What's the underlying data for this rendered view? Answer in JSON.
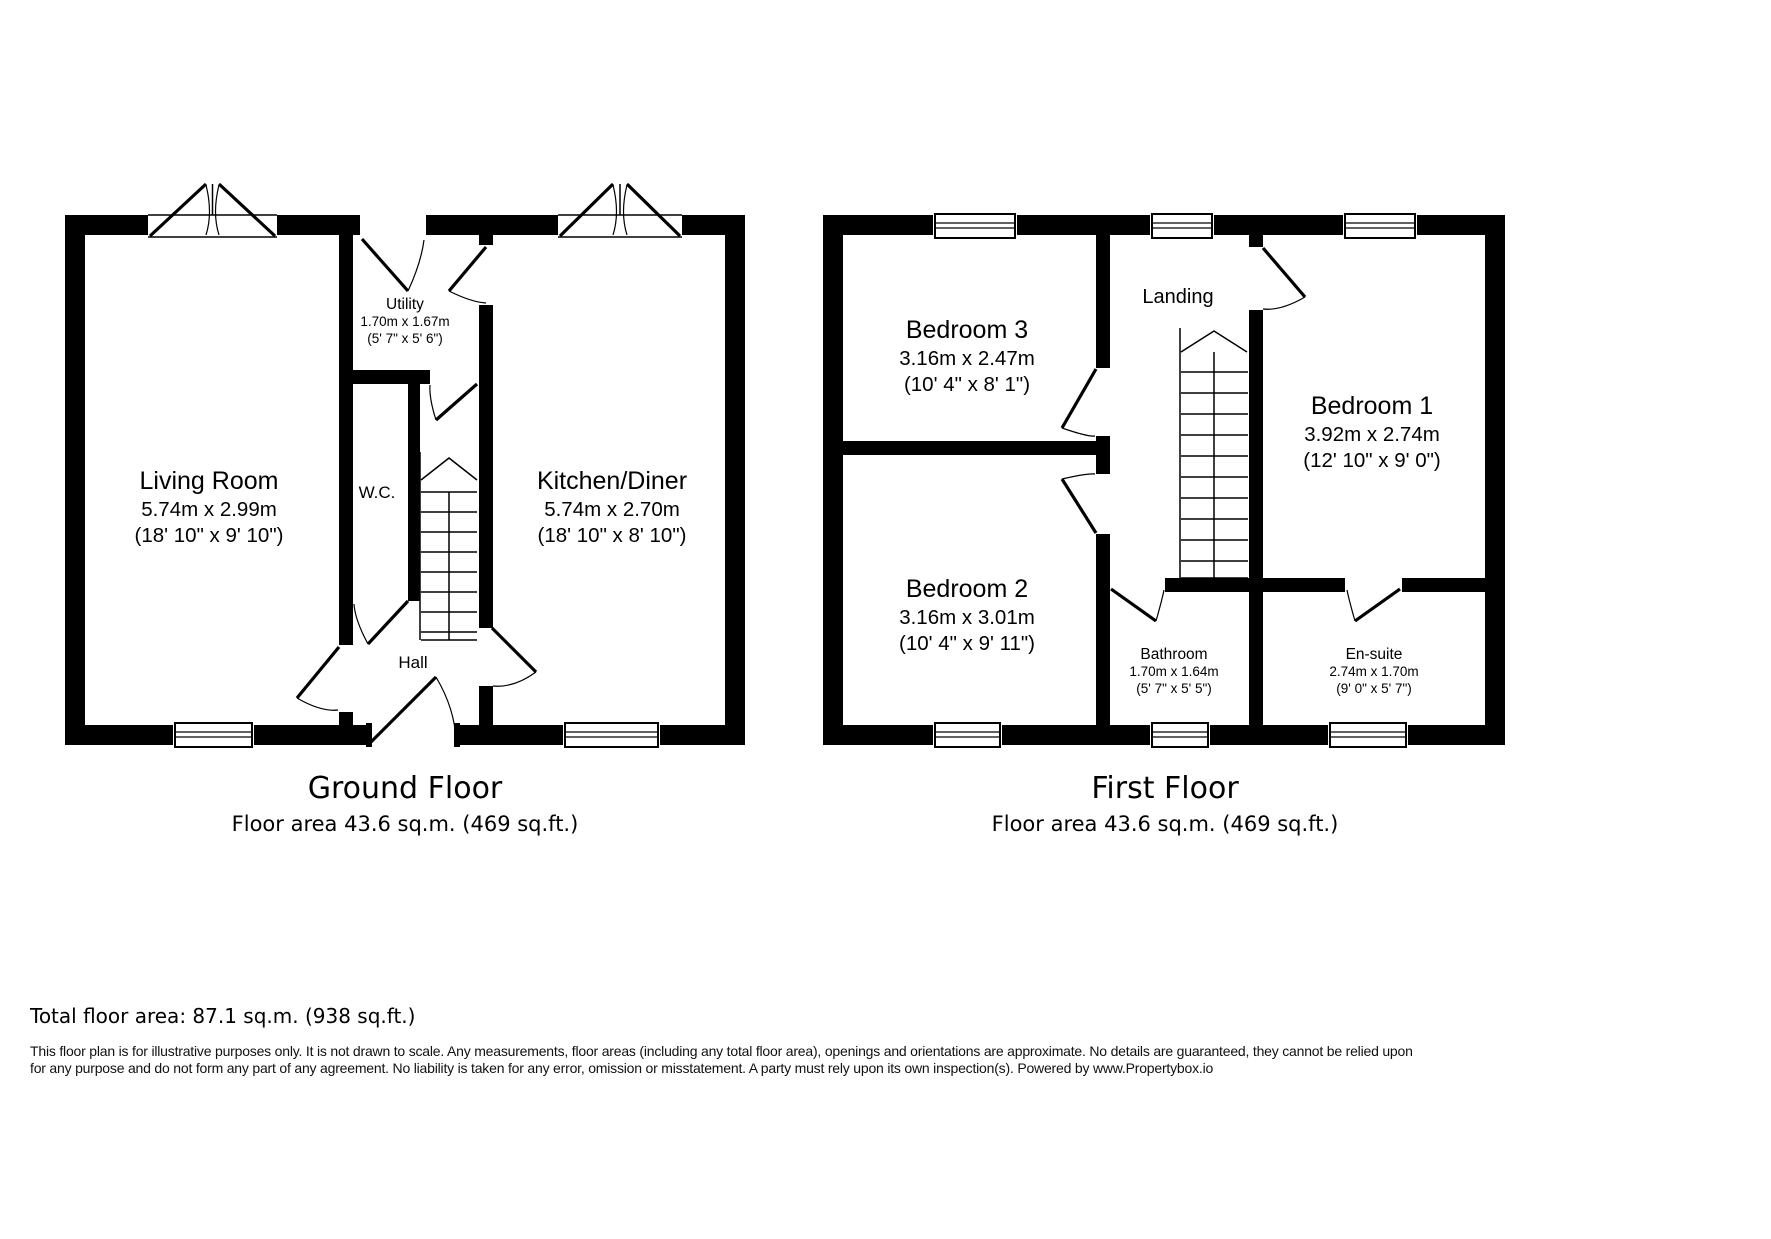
{
  "colors": {
    "wall": "#000000",
    "background": "#ffffff",
    "text": "#000000"
  },
  "ground_floor": {
    "title": "Ground Floor",
    "caption": "Floor area 43.6 sq.m. (469 sq.ft.)",
    "rooms": {
      "living_room": {
        "name": "Living Room",
        "metric": "5.74m x 2.99m",
        "imperial": "(18' 10\" x 9' 10\")"
      },
      "utility": {
        "name": "Utility",
        "metric": "1.70m x 1.67m",
        "imperial": "(5' 7\" x 5' 6\")"
      },
      "wc": {
        "name": "W.C."
      },
      "kitchen_diner": {
        "name": "Kitchen/Diner",
        "metric": "5.74m x 2.70m",
        "imperial": "(18' 10\" x 8' 10\")"
      },
      "hall": {
        "name": "Hall"
      }
    }
  },
  "first_floor": {
    "title": "First Floor",
    "caption": "Floor area 43.6 sq.m. (469 sq.ft.)",
    "rooms": {
      "bedroom_3": {
        "name": "Bedroom 3",
        "metric": "3.16m x 2.47m",
        "imperial": "(10' 4\" x 8' 1\")"
      },
      "landing": {
        "name": "Landing"
      },
      "bedroom_1": {
        "name": "Bedroom 1",
        "metric": "3.92m x 2.74m",
        "imperial": "(12' 10\" x 9' 0\")"
      },
      "bedroom_2": {
        "name": "Bedroom 2",
        "metric": "3.16m x 3.01m",
        "imperial": "(10' 4\" x 9' 11\")"
      },
      "bathroom": {
        "name": "Bathroom",
        "metric": "1.70m x 1.64m",
        "imperial": "(5' 7\" x 5' 5\")"
      },
      "ensuite": {
        "name": "En-suite",
        "metric": "2.74m x 1.70m",
        "imperial": "(9' 0\" x 5' 7\")"
      }
    }
  },
  "summary": {
    "total": "Total floor area: 87.1 sq.m. (938 sq.ft.)"
  },
  "disclaimer": {
    "line1": "This floor plan is for illustrative purposes only. It is not drawn to scale. Any measurements, floor areas (including any total floor area), openings and orientations are approximate. No details are guaranteed, they cannot be relied upon",
    "line2": "for any purpose and do not form any part of any agreement. No liability is taken for any error, omission or misstatement. A party must rely upon its own inspection(s). Powered by www.Propertybox.io"
  }
}
